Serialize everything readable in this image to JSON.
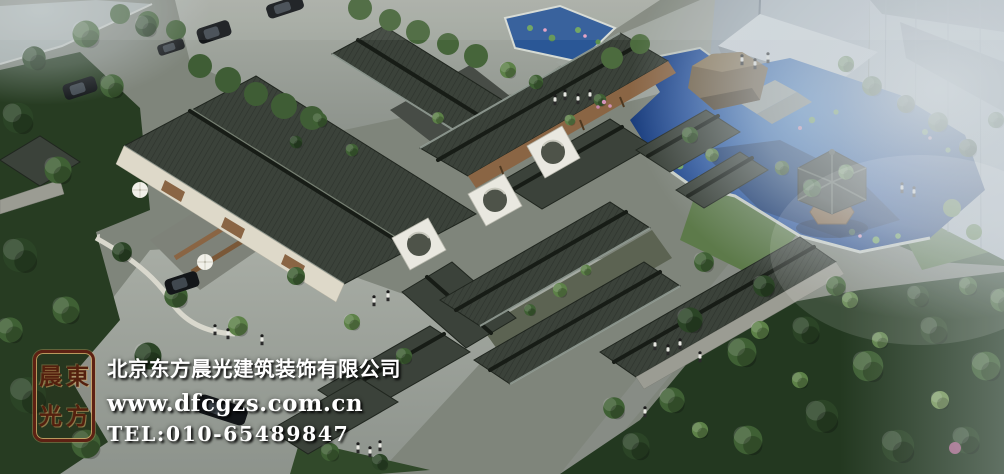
{
  "watermark": {
    "company_name": "北京东方晨光建筑装饰有限公司",
    "website": "www.dfcgzs.com.cn",
    "phone": "TEL:010-65489847",
    "text_color": "#ffffff"
  },
  "seal": {
    "chars": {
      "top_left": "晨",
      "top_right": "東",
      "bottom_left": "光",
      "bottom_right": "方"
    },
    "border_color": "#5e2113",
    "glyph_color": "#54200e",
    "highlight_color": "#d2a968"
  },
  "scene": {
    "description": "Aerial bird's-eye architectural rendering of a traditional Chinese siheyuan courtyard complex: dark grey tiled roofs around planted courtyards, white moon-gate walls, a blue lotus pond with large rock and hexagonal pavilion to the east, grey roads and parking with black cars to the north-west, pedestrians on paths, dense green trees all around, and fog-shrouded modern high-rise towers to the north-east.",
    "palette": {
      "roof": "#3b423a",
      "roof_ridge": "#1d231c",
      "stone_wall": "#9b9c93",
      "plaster_wall": "#ded9c9",
      "wood_facade": "#8a6544",
      "road": "#9aa09a",
      "pond_deep": "#0f2450",
      "pond_light": "#3f7cc4",
      "tree_dark": "#2b4426",
      "tree_mid": "#3f6034",
      "tree_light": "#5d8148",
      "highrise": "#a7b1b9",
      "fog": "#ccd4da"
    }
  }
}
